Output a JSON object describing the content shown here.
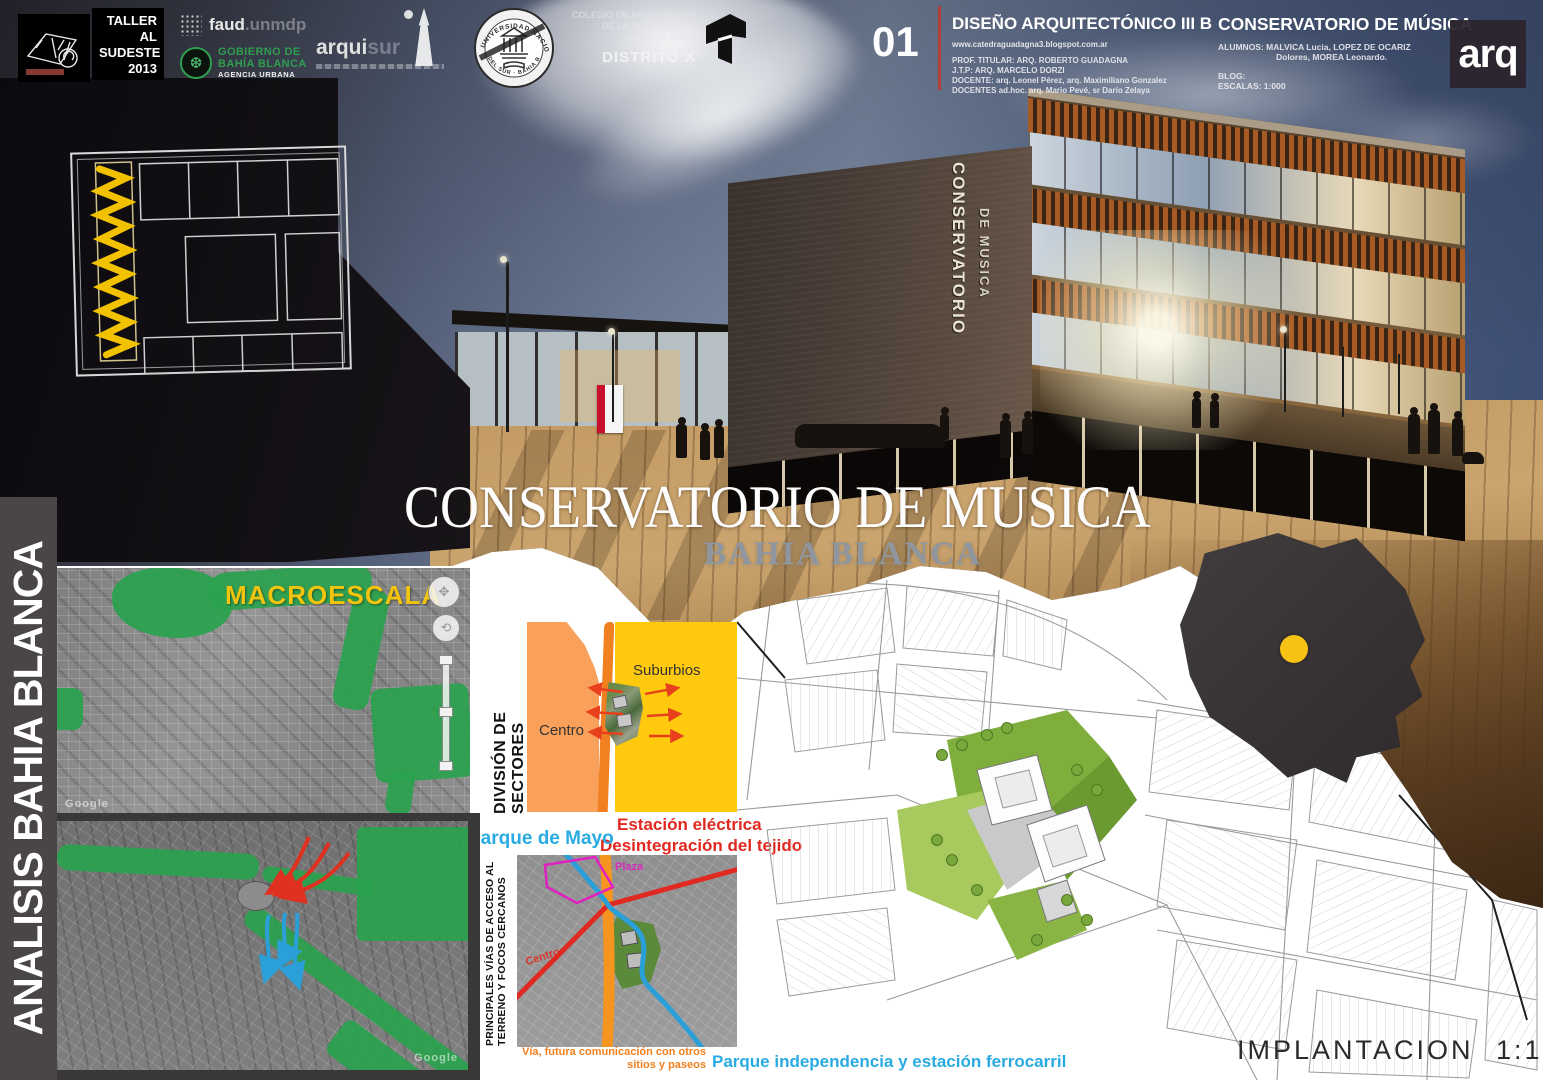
{
  "colors": {
    "accent_yellow": "#f2c40e",
    "map_green": "#2aa24d",
    "sector_light_orange": "#f9a05a",
    "sector_yellow": "#ffc90e",
    "road_orange": "#f08020",
    "note_red": "#e02920",
    "note_cyan": "#29abe2",
    "note_magenta": "#e020c0",
    "gobierno_green": "#2f9e4f",
    "sidebar_gray": "#4a4546",
    "site_dot_yellow": "#f6c213"
  },
  "header": {
    "taller": {
      "l1": "TALLER",
      "l2": "AL",
      "l3": "SUDESTE",
      "l4": "2013"
    },
    "faud": {
      "brand": "faud",
      "suffix": ".unmdp"
    },
    "gobierno": {
      "l1": "GOBIERNO DE",
      "l2": "BAHÍA BLANCA",
      "l3": "AGENCIA URBANA"
    },
    "arquisur": {
      "brand": "arqui",
      "suffix": "sur"
    },
    "seal": {
      "arc_top": "UNIVERSIDAD NACIONAL",
      "arc_bottom": "DEL SUR · BAHIA BLANCA"
    },
    "colegio": {
      "l1": "COLEGIO DE ARQUITECTOS",
      "l2": "DE LA PROVINCIA DE",
      "l3": "BUENOS AIRES",
      "distrito": "DISTRITO X"
    },
    "sheet_number": "01",
    "course": {
      "title": "DISEÑO ARQUITECTÓNICO III B",
      "url": "www.catedraguadagna3.blogspot.com.ar",
      "prof": "PROF. TITULAR: ARQ. ROBERTO GUADAGNA",
      "jtp": "J.T.P: ARQ. MARCELO DORZI",
      "docente": "DOCENTE: arq. Leonel Pérez, arq. Maximiliano Gonzalez",
      "adhoc": "DOCENTES ad.hoc. arq. Mario Pevé, sr Darío Zelaya"
    },
    "project": {
      "title": "CONSERVATORIO DE MÚSICA",
      "alumnos1": "ALUMNOS: MALVICA Lucia, LOPEZ DE OCARIZ",
      "alumnos2": "Dolores, MOREA Leonardo.",
      "blog": "BLOG:",
      "escalas": "ESCALAS: 1:000"
    },
    "arq_logo": "arq"
  },
  "hero": {
    "title": "CONSERVATORIO DE MUSICA",
    "subtitle": "BAHIA BLANCA",
    "sign1": "CONSERVATORIO",
    "sign2": "DE MUSICA"
  },
  "analysis": {
    "sidebar": "ANALISIS BAHIA BLANCA",
    "macro": "MACROESCALA",
    "sectors": {
      "label": "DIVISIÓN DE SECTORES",
      "centro": "Centro",
      "suburbios": "Suburbios",
      "red1": "Estación eléctrica",
      "red2": "Desintegración del tejido",
      "parque": "Parque de Mayo"
    },
    "access": {
      "label1": "PRINCIPALES VÍAS DE ACCESO AL",
      "label2": "TERRENO Y FOCOS CERCANOS",
      "plaza": "Plaza",
      "centro": "Centro",
      "orange1": "Vía, futura comunicación con otros",
      "orange2": "sitios y paseos",
      "cyan": "Parque independencia y estación ferrocarril"
    },
    "watermark": "Google"
  },
  "siteplan": {
    "caption": "IMPLANTACION  1:1000"
  }
}
